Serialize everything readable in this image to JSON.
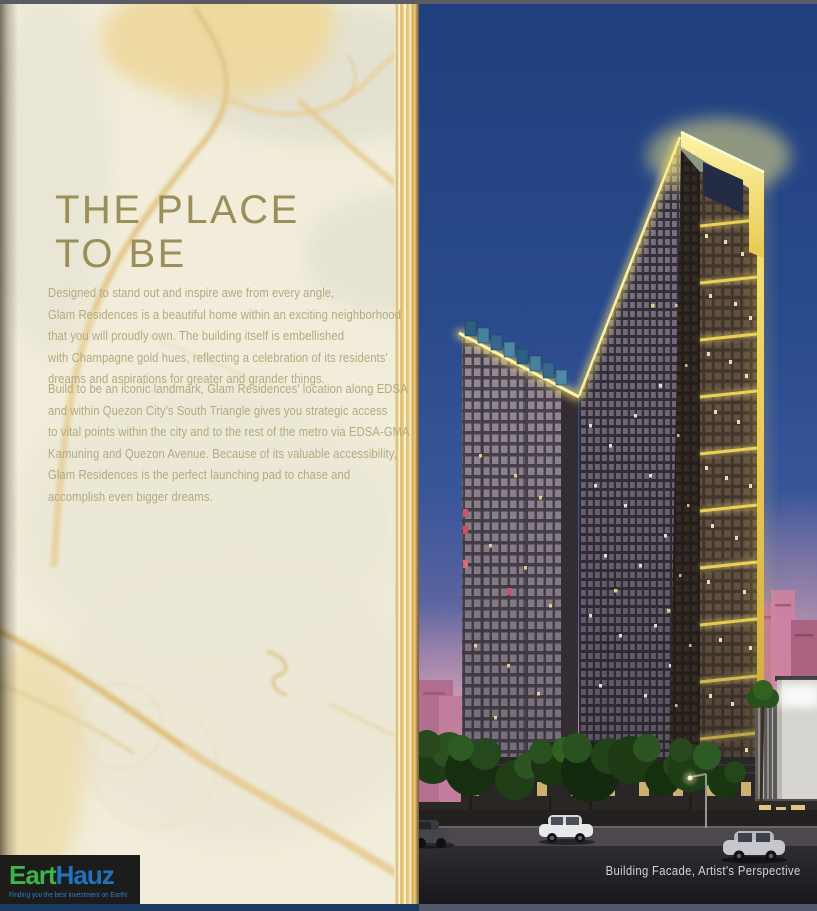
{
  "left": {
    "heading": "THE PLACE\nTO BE",
    "paragraph1": "Designed to stand out and inspire awe from every angle,\nGlam Residences is a beautiful home within an exciting neighborhood\nthat you will proudly own. The building itself is embellished\nwith Champagne gold hues, reflecting a celebration of its residents'\ndreams and aspirations for greater and grander things.",
    "paragraph2": "Build to be an iconic landmark, Glam Residences' location along EDSA\nand within Quezon City's South Triangle gives you strategic access\nto vital points within the city and to the rest of the metro via EDSA-GMA\nKamuning and Quezon Avenue. Because of its valuable accessibility,\nGlam Residences is the perfect launching pad to chase and\naccomplish even bigger dreams."
  },
  "logo": {
    "brand_green": "Eart",
    "brand_blue": "Hauz",
    "tagline": "Finding you the best investment on Earth!"
  },
  "right": {
    "caption": "Building Facade, Artist's Perspective"
  },
  "colors": {
    "heading_gold": "#9a8e59",
    "body_text": "#b3aa80",
    "marble_cream": "#f1edda",
    "marble_vein_gold": "#e8cf97",
    "gilded_edge_gold": "#ddb664",
    "logo_green": "#3cb44a",
    "logo_blue": "#1e73be",
    "sky_blue": "#294a8c",
    "sunset_pink": "#cf97ab",
    "building_crown_yellow": "#f2dc5e",
    "bottom_strip_left": "#1c3a5f",
    "bottom_strip_right": "#4f5969"
  }
}
